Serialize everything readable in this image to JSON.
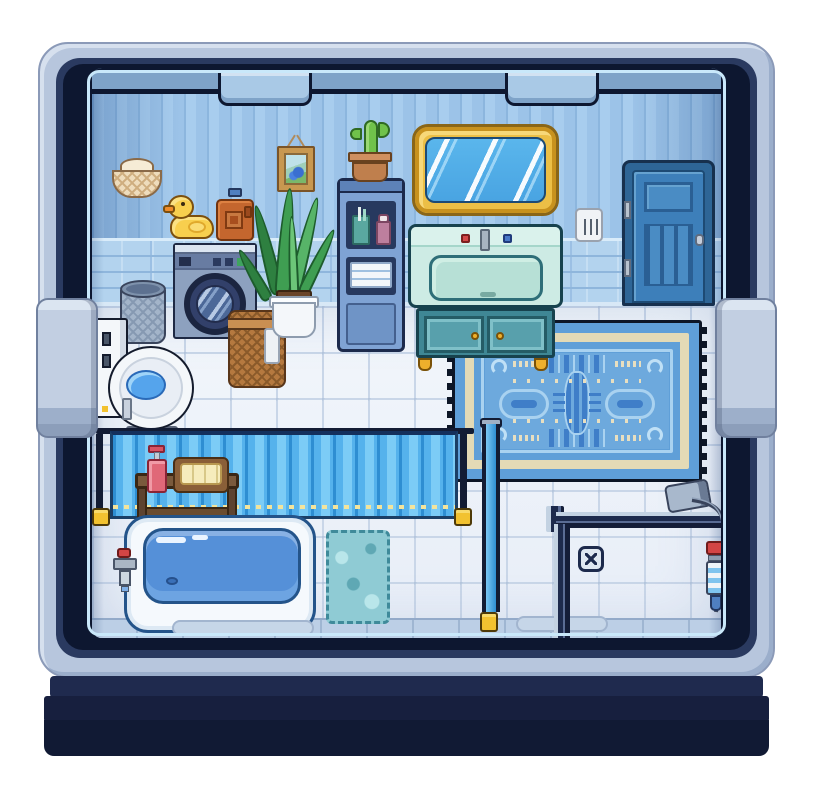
{
  "scene": {
    "name": "Pixel Art Bathroom",
    "description": "Top-down pixel-art bathroom room viewed through a rounded machine-style window frame with side handles and latch tabs",
    "text_visible": "none"
  },
  "palette": {
    "frame_light": "#b7c6dd",
    "frame_dark_navy": "#0d1730",
    "base_navy": "#111a34",
    "wall_stripe_blue": "#a8cdee",
    "wainscot_blue": "#b3d3ee",
    "floor_tile": "#eef3fa",
    "accent_gold": "#ecbf46",
    "accent_teal": "#3f8795",
    "water_blue": "#5590d8",
    "curtain_blue": "#55b2ec",
    "rug_blue": "#5f9fd8",
    "rug_cream": "#e3dab6",
    "duck_yellow": "#f8cf4e",
    "detergent_orange": "#c4662e",
    "wood_brown": "#7a5a3c",
    "wicker_brown": "#b5793f"
  },
  "objects": {
    "window_frame": {
      "label": "Rounded window frame"
    },
    "latch_tab_left": {
      "label": "Frame latch tab (left)"
    },
    "latch_tab_right": {
      "label": "Frame latch tab (right)"
    },
    "handle_left": {
      "label": "Left side handle"
    },
    "handle_right": {
      "label": "Right side handle"
    },
    "hanging_lamp": {
      "label": "Wicker hanging lamp"
    },
    "picture": {
      "label": "Framed picture of blue flowers"
    },
    "mirror": {
      "label": "Gold framed mirror"
    },
    "light_switch": {
      "label": "Light switch"
    },
    "door": {
      "label": "Blue paneled door"
    },
    "washing_machine": {
      "label": "Washing machine"
    },
    "rubber_duck": {
      "label": "Rubber duck"
    },
    "detergent": {
      "label": "Detergent bottle"
    },
    "trash_bin": {
      "label": "Mesh trash bin"
    },
    "toilet": {
      "label": "Toilet"
    },
    "laundry_basket": {
      "label": "Wicker laundry basket with towel"
    },
    "plant": {
      "label": "Potted snake plant"
    },
    "shelf": {
      "label": "Blue bathroom shelf with toiletries"
    },
    "cactus": {
      "label": "Potted cactus"
    },
    "sink_vanity": {
      "label": "Teal sink vanity with gold knobs"
    },
    "rug": {
      "label": "Ornate blue bath rug"
    },
    "shower_curtain": {
      "label": "Blue shower curtain on rail"
    },
    "curtain_rail": {
      "label": "Shower curtain rail and poles"
    },
    "bench": {
      "label": "Wooden bench"
    },
    "soap_dispenser": {
      "label": "Red soap dispenser"
    },
    "towel_tray": {
      "label": "Tray with folded towels"
    },
    "bathtub": {
      "label": "Bathtub filled with water"
    },
    "tub_faucet": {
      "label": "Bathtub faucet"
    },
    "bath_mat": {
      "label": "Teal bath mat"
    },
    "shower_partition": {
      "label": "Walk-in shower glass partition"
    },
    "shower_drain": {
      "label": "Shower floor drain"
    },
    "shower_head": {
      "label": "Handheld shower head"
    },
    "shower_control": {
      "label": "Shower control unit"
    }
  }
}
